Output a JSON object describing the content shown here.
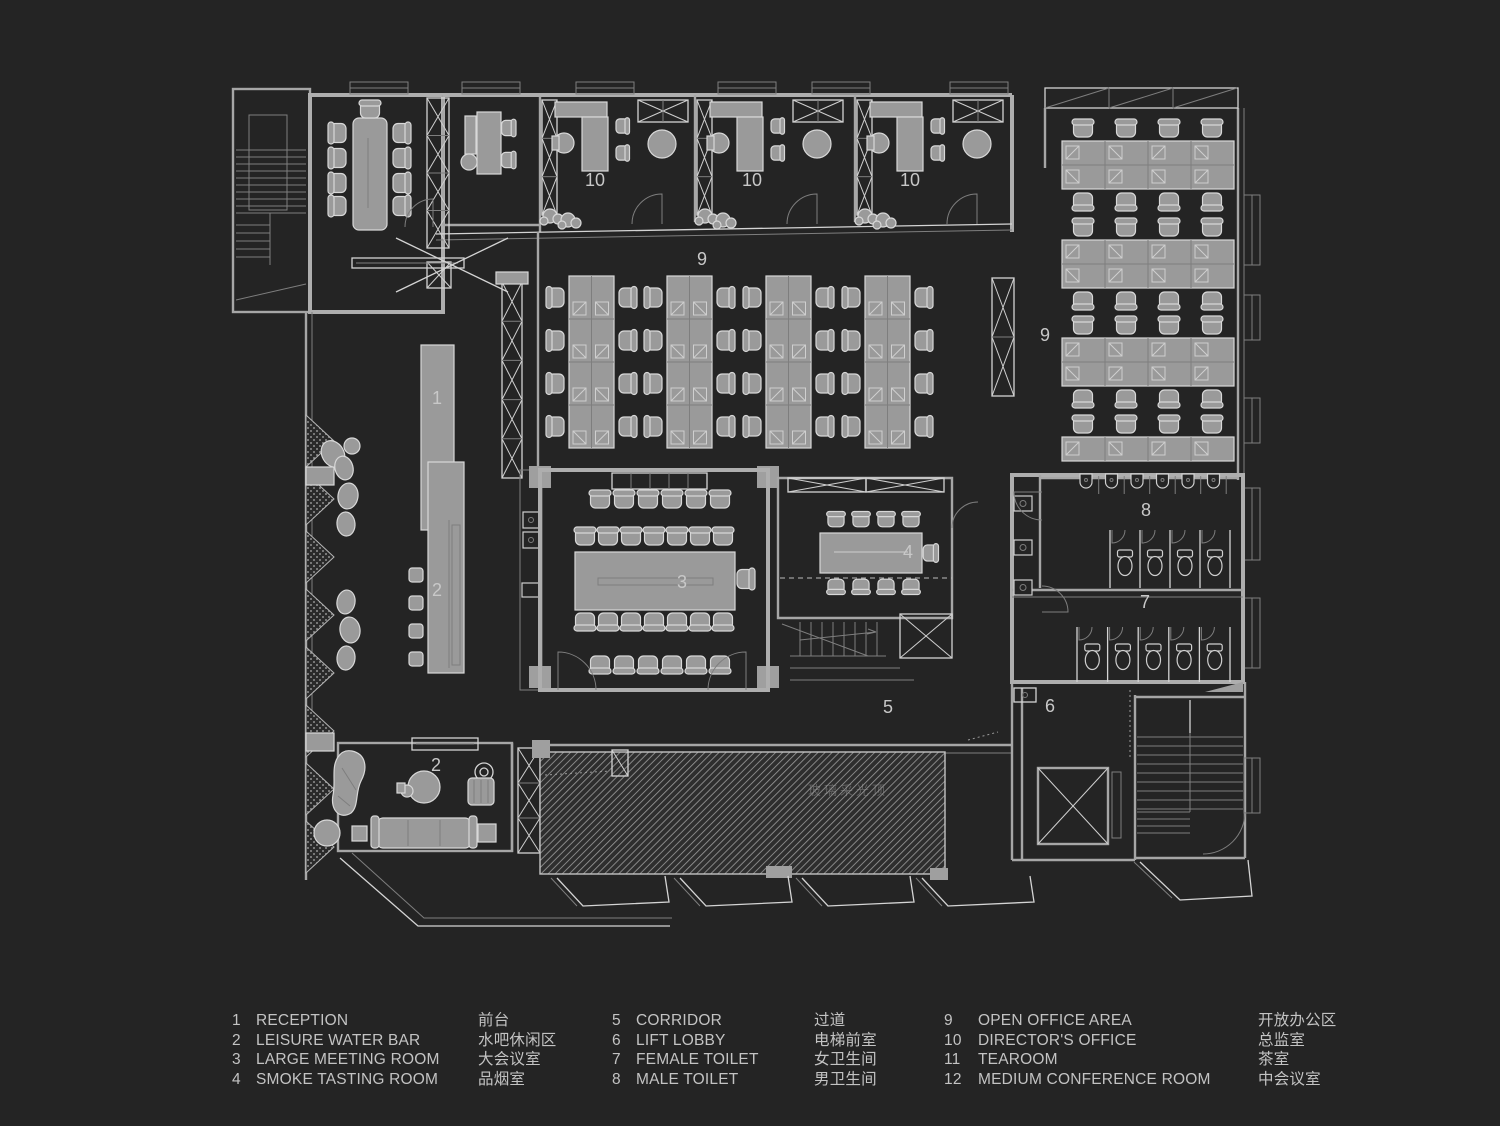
{
  "colors": {
    "background": "#242424",
    "walls": "#aeaeae",
    "bright_line": "#d4d4d4",
    "furniture": "#9a9a9a",
    "label": "#c8c8c8",
    "legend_text": "#c3c3c3"
  },
  "plan": {
    "watermark": "玻璃采光顶",
    "labels": [
      {
        "text": "1",
        "x": 437,
        "y": 404
      },
      {
        "text": "2",
        "x": 437,
        "y": 596
      },
      {
        "text": "2",
        "x": 436,
        "y": 771
      },
      {
        "text": "3",
        "x": 682,
        "y": 588
      },
      {
        "text": "4",
        "x": 908,
        "y": 558
      },
      {
        "text": "5",
        "x": 888,
        "y": 713
      },
      {
        "text": "6",
        "x": 1050,
        "y": 712
      },
      {
        "text": "7",
        "x": 1145,
        "y": 608
      },
      {
        "text": "8",
        "x": 1146,
        "y": 516
      },
      {
        "text": "9",
        "x": 702,
        "y": 265
      },
      {
        "text": "9",
        "x": 1045,
        "y": 341
      },
      {
        "text": "10",
        "x": 595,
        "y": 186
      },
      {
        "text": "10",
        "x": 752,
        "y": 186
      },
      {
        "text": "10",
        "x": 910,
        "y": 186
      }
    ]
  },
  "legend": {
    "columns": [
      {
        "items": [
          {
            "num": "1",
            "en": "RECEPTION",
            "zh": "前台"
          },
          {
            "num": "2",
            "en": "LEISURE WATER BAR",
            "zh": "水吧休闲区"
          },
          {
            "num": "3",
            "en": "LARGE MEETING ROOM",
            "zh": "大会议室"
          },
          {
            "num": "4",
            "en": "SMOKE TASTING ROOM",
            "zh": "品烟室"
          }
        ]
      },
      {
        "items": [
          {
            "num": "5",
            "en": "CORRIDOR",
            "zh": "过道"
          },
          {
            "num": "6",
            "en": "LIFT LOBBY",
            "zh": "电梯前室"
          },
          {
            "num": "7",
            "en": "FEMALE TOILET",
            "zh": "女卫生间"
          },
          {
            "num": "8",
            "en": "MALE TOILET",
            "zh": "男卫生间"
          }
        ]
      },
      {
        "items": [
          {
            "num": "9",
            "en": "OPEN OFFICE AREA",
            "zh": "开放办公区"
          },
          {
            "num": "10",
            "en": "DIRECTOR'S OFFICE",
            "zh": "总监室"
          },
          {
            "num": "11",
            "en": "TEAROOM",
            "zh": "茶室"
          },
          {
            "num": "12",
            "en": "MEDIUM CONFERENCE ROOM",
            "zh": "中会议室"
          }
        ]
      }
    ]
  }
}
